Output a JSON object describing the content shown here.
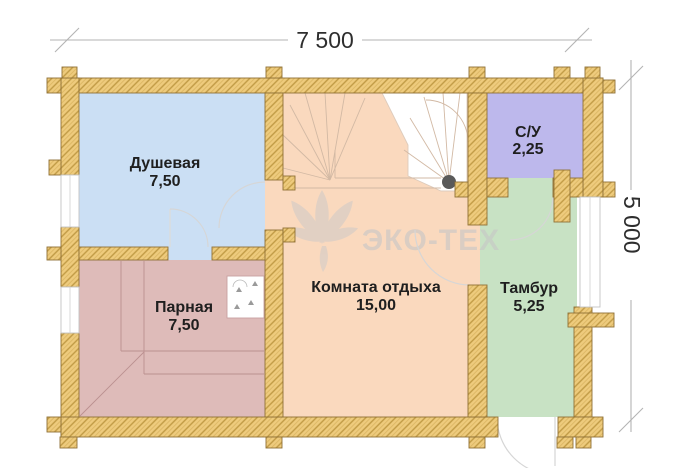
{
  "dimensions": {
    "width": "7 500",
    "height": "5 000"
  },
  "rooms": [
    {
      "name": "Душевая",
      "area": "7,50",
      "color": "#cbdff4"
    },
    {
      "name": "Парная",
      "area": "7,50",
      "color": "#debbb9"
    },
    {
      "name": "Комната отдыха",
      "area": "15,00",
      "color": "#fad9be"
    },
    {
      "name": "С/У",
      "area": "2,25",
      "color": "#bdb8ec"
    },
    {
      "name": "Тамбур",
      "area": "5,25",
      "color": "#c8e2c4"
    }
  ],
  "watermark": {
    "brand": "ЭКО-ТЕХ"
  },
  "colors": {
    "wall_fill": "#eecb7d",
    "wall_hatch": "#c09a44",
    "wall_outline": "#8f7136",
    "dim_line": "#b3b3b3",
    "label_text": "#1f1f1f",
    "stair_newel": "#5a5a5a"
  }
}
